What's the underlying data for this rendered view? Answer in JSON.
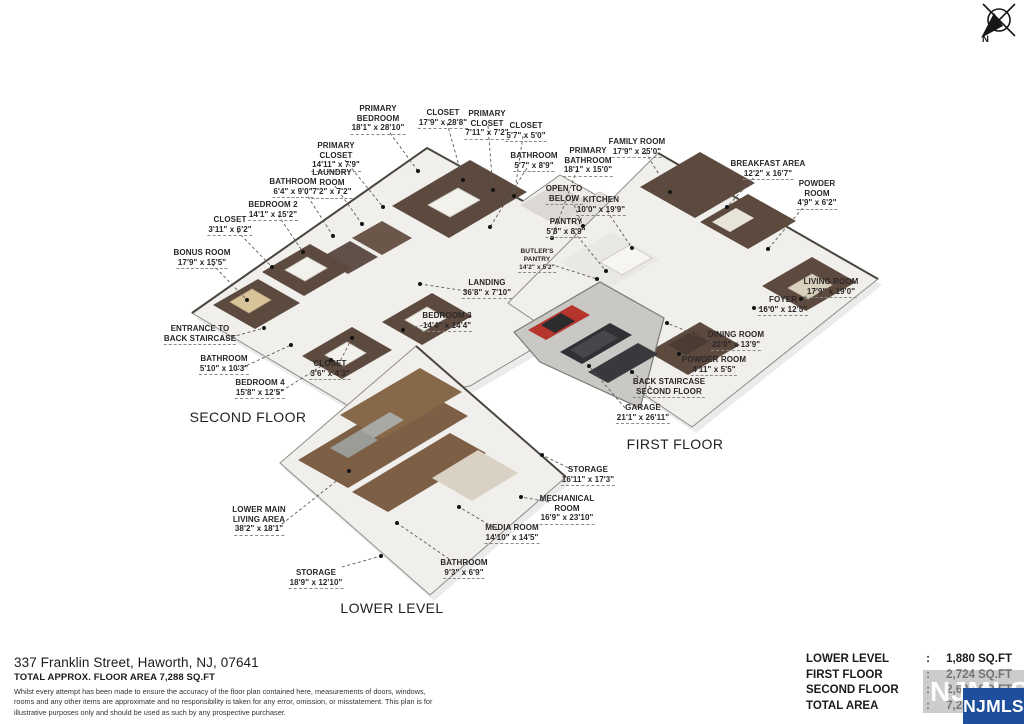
{
  "meta": {
    "address": "337 Franklin Street, Haworth, NJ, 07641",
    "total_area_line": "TOTAL APPROX. FLOOR AREA 7,288 SQ.FT",
    "disclaimer": "Whilst every attempt has been made to ensure the accuracy of the floor plan contained here, measurements of doors, windows, rooms and any other items are approximate and no responsibility is taken for any error, omission, or misstatement. This plan is for illustrative purposes only and should be used as such by any prospective purchaser."
  },
  "compass": {
    "north_label": "N"
  },
  "floors": {
    "second": {
      "title": "SECOND FLOOR",
      "rooms": [
        {
          "name": "PRIMARY\nBEDROOM",
          "dims": "18'1\" x 28'10\""
        },
        {
          "name": "CLOSET",
          "dims": "17'9\" x 28'8\""
        },
        {
          "name": "PRIMARY\nCLOSET",
          "dims": "7'11\" x 7'2\""
        },
        {
          "name": "CLOSET",
          "dims": "5'7\" x 5'0\""
        },
        {
          "name": "PRIMARY\nCLOSET",
          "dims": "14'11\" x 7'9\""
        },
        {
          "name": "LAUNDRY\nROOM",
          "dims": "7'2\" x 7'2\""
        },
        {
          "name": "BATHROOM",
          "dims": "6'4\" x 9'0\""
        },
        {
          "name": "BEDROOM 2",
          "dims": "14'1\" x 15'2\""
        },
        {
          "name": "CLOSET",
          "dims": "3'11\" x 6'2\""
        },
        {
          "name": "BONUS ROOM",
          "dims": "17'9\" x 15'5\""
        },
        {
          "name": "BATHROOM",
          "dims": "5'7\" x 8'9\""
        },
        {
          "name": "PRIMARY\nBATHROOM",
          "dims": "18'1\" x 15'0\""
        },
        {
          "name": "ENTRANCE TO\nBACK STAIRCASE",
          "dims": ""
        },
        {
          "name": "BATHROOM",
          "dims": "5'10\" x 10'3\""
        },
        {
          "name": "BEDROOM 4",
          "dims": "15'8\" x 12'5\""
        },
        {
          "name": "CLOSET",
          "dims": "3'6\" x 4'3\""
        },
        {
          "name": "LANDING",
          "dims": "36'8\" x 7'10\""
        },
        {
          "name": "BEDROOM 3",
          "dims": "14'4\" x 14'4\""
        }
      ]
    },
    "first": {
      "title": "FIRST FLOOR",
      "rooms": [
        {
          "name": "FAMILY ROOM",
          "dims": "17'9\" x 25'0\""
        },
        {
          "name": "BREAKFAST AREA",
          "dims": "12'2\" x 16'7\""
        },
        {
          "name": "POWDER\nROOM",
          "dims": "4'9\" x 6'2\""
        },
        {
          "name": "OPEN TO\nBELOW",
          "dims": ""
        },
        {
          "name": "KITCHEN",
          "dims": "10'0\" x 19'9\""
        },
        {
          "name": "PANTRY",
          "dims": "5'8\" x 8'9\""
        },
        {
          "name": "BUTLER'S\nPANTRY",
          "dims": "14'2\" x 5'2\""
        },
        {
          "name": "LIVING ROOM",
          "dims": "17'9\" x 19'0\""
        },
        {
          "name": "FOYER",
          "dims": "16'0\" x 12'5\""
        },
        {
          "name": "DINING ROOM",
          "dims": "20'0\" x 13'9\""
        },
        {
          "name": "POWDER ROOM",
          "dims": "4'11\" x 5'5\""
        },
        {
          "name": "BACK STAIRCASE\nSECOND FLOOR",
          "dims": ""
        },
        {
          "name": "GARAGE",
          "dims": "21'1\" x 26'11\""
        }
      ]
    },
    "lower": {
      "title": "LOWER LEVEL",
      "rooms": [
        {
          "name": "LOWER MAIN\nLIVING AREA",
          "dims": "38'2\" x 18'1\""
        },
        {
          "name": "STORAGE",
          "dims": "16'11\" x 17'3\""
        },
        {
          "name": "MECHANICAL\nROOM",
          "dims": "16'9\" x 23'10\""
        },
        {
          "name": "MEDIA ROOM",
          "dims": "14'10\" x 14'5\""
        },
        {
          "name": "BATHROOM",
          "dims": "9'3\" x 6'9\""
        },
        {
          "name": "STORAGE",
          "dims": "18'9\" x 12'10\""
        }
      ]
    }
  },
  "area_table": {
    "rows": [
      {
        "label": "LOWER LEVEL",
        "colon": ":",
        "value": "1,880 SQ.FT"
      },
      {
        "label": "FIRST FLOOR",
        "colon": ":",
        "value": "2,724 SQ.FT"
      },
      {
        "label": "SECOND FLOOR",
        "colon": ":",
        "value": "2,684 SQ.FT"
      },
      {
        "label": "TOTAL AREA",
        "colon": ":",
        "value": "7,288 SQ.FT"
      }
    ]
  },
  "watermark": {
    "text": "NJMLS"
  },
  "colors": {
    "njmls_blue": "#1e4e9c",
    "car_red": "#b5342c",
    "room_brown": "#5d4a3f",
    "wood": "#7d5f46"
  }
}
